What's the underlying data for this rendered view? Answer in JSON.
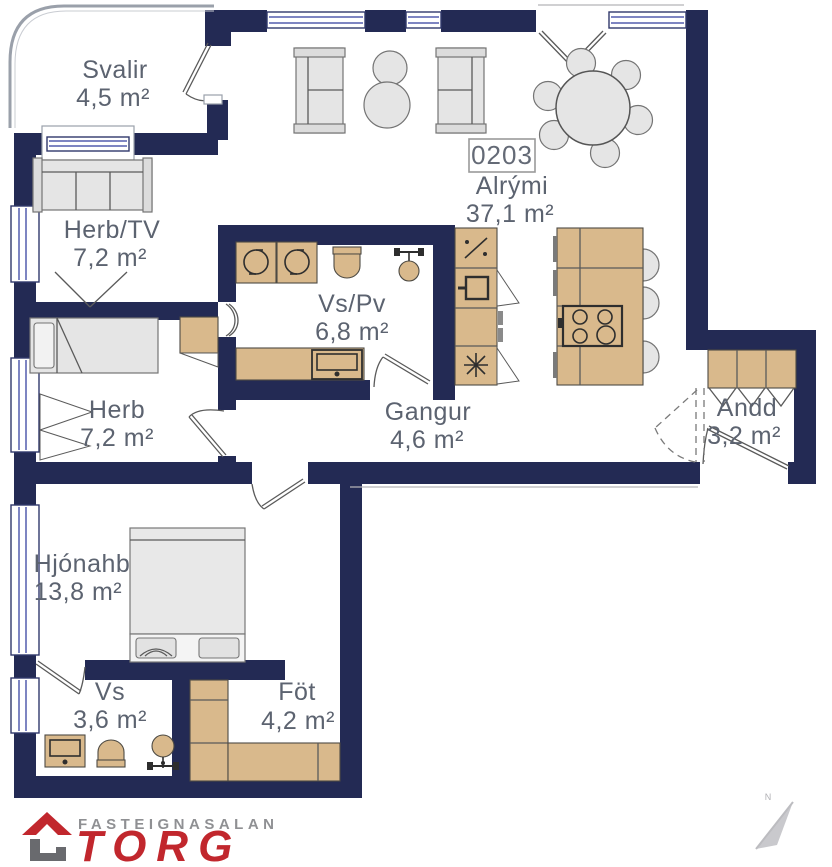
{
  "plan": {
    "unit": {
      "number": "0203"
    },
    "rooms": [
      {
        "id": "svalir",
        "name": "Svalir",
        "area": "4,5 m²"
      },
      {
        "id": "herb-tv",
        "name": "Herb/TV",
        "area": "7,2 m²"
      },
      {
        "id": "vs-pv",
        "name": "Vs/Pv",
        "area": "6,8 m²"
      },
      {
        "id": "alrymi",
        "name": "Alrými",
        "area": "37,1 m²"
      },
      {
        "id": "herb",
        "name": "Herb",
        "area": "7,2 m²"
      },
      {
        "id": "gangur",
        "name": "Gangur",
        "area": "4,6 m²"
      },
      {
        "id": "andd",
        "name": "Andd",
        "area": "3,2 m²"
      },
      {
        "id": "hjonahb",
        "name": "Hjónahb",
        "area": "13,8 m²"
      },
      {
        "id": "vs",
        "name": "Vs",
        "area": "3,6 m²"
      },
      {
        "id": "fot",
        "name": "Föt",
        "area": "4,2 m²"
      }
    ],
    "compass": {
      "label": "N"
    },
    "colors": {
      "wall": "#232a54",
      "wood": "#d9b98c",
      "furniture": "#e5e5e5",
      "window": "#7e85c2",
      "label": "#5c6370",
      "logo_red": "#c1272d",
      "logo_gray": "#8f9093"
    }
  },
  "logo": {
    "company": "FASTEIGNASALAN",
    "brand": "TORG"
  }
}
